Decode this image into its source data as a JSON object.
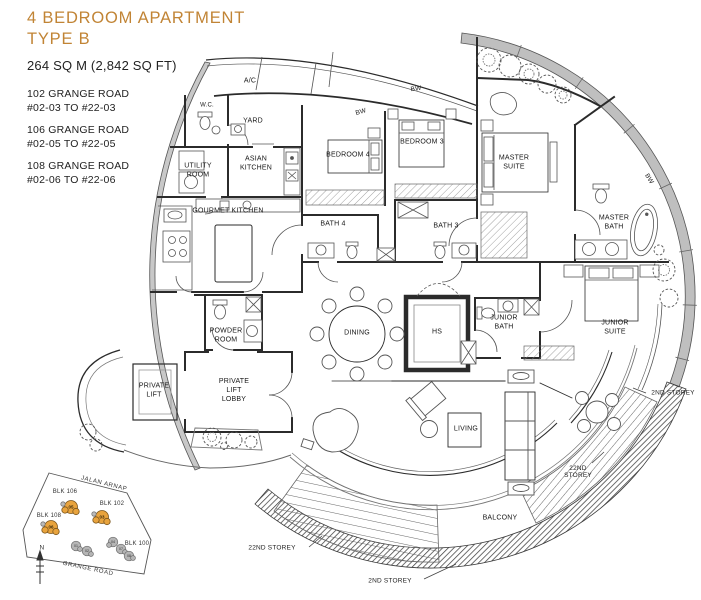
{
  "header": {
    "title_line1": "4 BEDROOM APARTMENT",
    "title_line2": "TYPE B",
    "area": "264 SQ M (2,842 SQ FT)"
  },
  "addresses": [
    {
      "road": "102 GRANGE ROAD",
      "units": "#02-03 TO #22-03"
    },
    {
      "road": "106 GRANGE ROAD",
      "units": "#02-05 TO #22-05"
    },
    {
      "road": "108 GRANGE ROAD",
      "units": "#02-06 TO #22-06"
    }
  ],
  "rooms": {
    "ac": "A/C",
    "wc": "W.C.",
    "yard": "YARD",
    "utility": "UTILITY ROOM",
    "asian_kitchen": "ASIAN KITCHEN",
    "gourmet_kitchen": "GOURMET KITCHEN",
    "bedroom4": "BEDROOM 4",
    "bedroom3": "BEDROOM 3",
    "master_suite": "MASTER SUITE",
    "master_bath": "MASTER BATH",
    "bath4": "BATH 4",
    "bath3": "BATH 3",
    "dining": "DINING",
    "hs": "HS",
    "junior_bath": "JUNIOR BATH",
    "junior_suite": "JUNIOR SUITE",
    "powder": "POWDER ROOM",
    "private_lift": "PRIVATE LIFT",
    "lift_lobby": "PRIVATE LIFT LOBBY",
    "living": "LIVING",
    "balcony": "BALCONY"
  },
  "labels": {
    "bw": "BW",
    "storey_22nd": "22ND STOREY",
    "storey_2nd": "2ND STOREY"
  },
  "site_map": {
    "road_top": "JALAN ARNAP",
    "road_bottom": "GRANGE ROAD",
    "compass": "N",
    "blocks": [
      {
        "name": "BLK 106",
        "unit": "05"
      },
      {
        "name": "BLK 102",
        "unit": "03"
      },
      {
        "name": "BLK 108",
        "unit": "06"
      },
      {
        "name": "BLK 100",
        "unit": ""
      }
    ],
    "other_units": [
      "01",
      "02",
      "04",
      "07",
      "08"
    ]
  },
  "colors": {
    "accent": "#c18435",
    "highlight_unit": "#e8a33d",
    "wall_grey": "#bfbfbf",
    "line": "#2b2b2b"
  }
}
